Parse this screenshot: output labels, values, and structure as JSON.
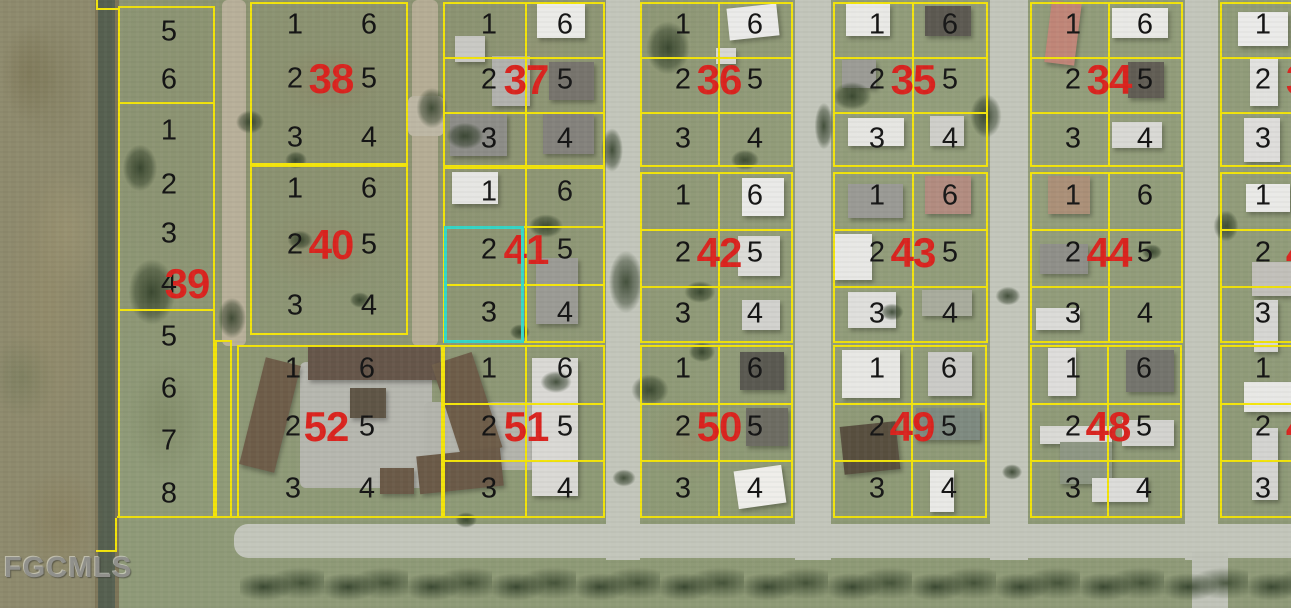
{
  "watermark": "FGCMLS",
  "colors": {
    "parcel_line": "#f3e40b",
    "block_number": "#da241f",
    "lot_number": "#151515",
    "highlight": "#35d8c8",
    "road": "#c3c6bb",
    "grass": "#8f9a78"
  },
  "highlighted_parcel": {
    "block": "41",
    "lots": [
      "2",
      "3"
    ]
  },
  "map": {
    "width": 1291,
    "height": 608,
    "highlight": {
      "x": 444,
      "y": 226,
      "w": 80,
      "h": 117
    },
    "blocks": [
      {
        "number": "38",
        "x": 250,
        "y": 2,
        "w": 158,
        "h": 163,
        "lots_left": [
          "1",
          "2",
          "3"
        ],
        "lots_right": [
          "6",
          "5",
          "4"
        ],
        "internal": false,
        "partial": false
      },
      {
        "number": "37",
        "x": 443,
        "y": 2,
        "w": 162,
        "h": 165,
        "lots_left": [
          "1",
          "2",
          "3"
        ],
        "lots_right": [
          "6",
          "5",
          "4"
        ],
        "internal": true,
        "partial": false
      },
      {
        "number": "36",
        "x": 640,
        "y": 2,
        "w": 153,
        "h": 165,
        "lots_left": [
          "1",
          "2",
          "3"
        ],
        "lots_right": [
          "6",
          "5",
          "4"
        ],
        "internal": true,
        "partial": false
      },
      {
        "number": "35",
        "x": 833,
        "y": 2,
        "w": 155,
        "h": 165,
        "lots_left": [
          "1",
          "2",
          "3"
        ],
        "lots_right": [
          "6",
          "5",
          "4"
        ],
        "internal": true,
        "partial": false
      },
      {
        "number": "34",
        "x": 1030,
        "y": 2,
        "w": 153,
        "h": 165,
        "lots_left": [
          "1",
          "2",
          "3"
        ],
        "lots_right": [
          "6",
          "5",
          "4"
        ],
        "internal": true,
        "partial": false
      },
      {
        "number": "3",
        "x": 1220,
        "y": 2,
        "w": 150,
        "h": 165,
        "lots_left": [
          "1",
          "2",
          "3"
        ],
        "lots_right": [],
        "internal": true,
        "partial": true
      },
      {
        "number": "40",
        "x": 250,
        "y": 165,
        "w": 158,
        "h": 170,
        "lots_left": [
          "1",
          "2",
          "3"
        ],
        "lots_right": [
          "6",
          "5",
          "4"
        ],
        "internal": false,
        "partial": false
      },
      {
        "number": "41",
        "x": 443,
        "y": 167,
        "w": 162,
        "h": 176,
        "lots_left": [
          "1",
          "2",
          "3"
        ],
        "lots_right": [
          "6",
          "5",
          "4"
        ],
        "internal": true,
        "partial": false
      },
      {
        "number": "42",
        "x": 640,
        "y": 172,
        "w": 153,
        "h": 171,
        "lots_left": [
          "1",
          "2",
          "3"
        ],
        "lots_right": [
          "6",
          "5",
          "4"
        ],
        "internal": true,
        "partial": false
      },
      {
        "number": "43",
        "x": 833,
        "y": 172,
        "w": 155,
        "h": 171,
        "lots_left": [
          "1",
          "2",
          "3"
        ],
        "lots_right": [
          "6",
          "5",
          "4"
        ],
        "internal": true,
        "partial": false
      },
      {
        "number": "44",
        "x": 1030,
        "y": 172,
        "w": 153,
        "h": 171,
        "lots_left": [
          "1",
          "2",
          "3"
        ],
        "lots_right": [
          "6",
          "5",
          "4"
        ],
        "internal": true,
        "partial": false
      },
      {
        "number": "4",
        "x": 1220,
        "y": 172,
        "w": 150,
        "h": 171,
        "lots_left": [
          "1",
          "2",
          "3"
        ],
        "lots_right": [],
        "internal": true,
        "partial": true
      },
      {
        "number": "52",
        "x": 237,
        "y": 345,
        "w": 206,
        "h": 173,
        "lots_left": [
          "1",
          "2",
          "3"
        ],
        "lots_right": [
          "6",
          "5",
          "4"
        ],
        "internal": false,
        "partial": false,
        "left_fx": 0.26,
        "right_fx": 0.62,
        "red_fx": 0.42
      },
      {
        "number": "51",
        "x": 443,
        "y": 345,
        "w": 162,
        "h": 173,
        "lots_left": [
          "1",
          "2",
          "3"
        ],
        "lots_right": [
          "6",
          "5",
          "4"
        ],
        "internal": true,
        "partial": false
      },
      {
        "number": "50",
        "x": 640,
        "y": 345,
        "w": 153,
        "h": 173,
        "lots_left": [
          "1",
          "2",
          "3"
        ],
        "lots_right": [
          "6",
          "5",
          "4"
        ],
        "internal": true,
        "partial": false
      },
      {
        "number": "49",
        "x": 833,
        "y": 345,
        "w": 154,
        "h": 173,
        "lots_left": [
          "1",
          "2",
          "3"
        ],
        "lots_right": [
          "6",
          "5",
          "4"
        ],
        "internal": true,
        "partial": false
      },
      {
        "number": "48",
        "x": 1030,
        "y": 345,
        "w": 152,
        "h": 173,
        "lots_left": [
          "1",
          "2",
          "3"
        ],
        "lots_right": [
          "6",
          "5",
          "4"
        ],
        "internal": true,
        "partial": false
      },
      {
        "number": "4",
        "x": 1220,
        "y": 345,
        "w": 150,
        "h": 173,
        "lots_left": [
          "1",
          "2",
          "3"
        ],
        "lots_right": [],
        "internal": true,
        "partial": true
      }
    ],
    "left_strip": {
      "x": 118,
      "y": 6,
      "w": 97,
      "red_number": "39",
      "red_cx": 67,
      "red_cy": 276,
      "lots": [
        {
          "label": "5",
          "h": 48
        },
        {
          "label": "6",
          "h": 48
        },
        {
          "label": "1",
          "h": 54
        },
        {
          "label": "2",
          "h": 53
        },
        {
          "label": "3",
          "h": 46
        },
        {
          "label": "4",
          "h": 54
        },
        {
          "label": "5",
          "h": 52
        },
        {
          "label": "6",
          "h": 52
        },
        {
          "label": "7",
          "h": 52
        },
        {
          "label": "8",
          "h": 53
        }
      ],
      "dividers_after": [
        1,
        5
      ],
      "extension": {
        "x": 215,
        "y": 340,
        "w": 17,
        "h": 178
      }
    },
    "extra_lines": [
      {
        "x": 96,
        "y": 0,
        "w": 2,
        "h": 10
      },
      {
        "x": 96,
        "y": 8,
        "w": 24,
        "h": 2
      },
      {
        "x": 115,
        "y": 518,
        "w": 2,
        "h": 34
      },
      {
        "x": 96,
        "y": 550,
        "w": 21,
        "h": 2
      },
      {
        "x": 117,
        "y": 516,
        "w": 122,
        "h": 2
      }
    ],
    "paved": [
      {
        "x": 222,
        "y": 0,
        "w": 24,
        "h": 346,
        "c": "#b8b09a"
      },
      {
        "x": 412,
        "y": 0,
        "w": 26,
        "h": 346,
        "c": "#b5ad95"
      },
      {
        "x": 408,
        "y": 96,
        "w": 36,
        "h": 40,
        "c": "#bdb7a4"
      },
      {
        "x": 300,
        "y": 362,
        "w": 132,
        "h": 126,
        "c": "#b6b7af"
      },
      {
        "x": 424,
        "y": 402,
        "w": 112,
        "h": 68,
        "c": "#b3b4ac"
      }
    ],
    "buildings": [
      {
        "x": 537,
        "y": 4,
        "w": 48,
        "h": 34,
        "c": "#ebebe8",
        "r": 0
      },
      {
        "x": 492,
        "y": 56,
        "w": 38,
        "h": 50,
        "c": "#b2b2ae",
        "r": 0
      },
      {
        "x": 549,
        "y": 62,
        "w": 45,
        "h": 38,
        "c": "#77746d",
        "r": 0
      },
      {
        "x": 450,
        "y": 114,
        "w": 57,
        "h": 42,
        "c": "#8d8d88",
        "r": 0
      },
      {
        "x": 543,
        "y": 114,
        "w": 51,
        "h": 40,
        "c": "#84827c",
        "r": 0
      },
      {
        "x": 455,
        "y": 36,
        "w": 30,
        "h": 26,
        "c": "#c9c9c4",
        "r": 0
      },
      {
        "x": 728,
        "y": 6,
        "w": 50,
        "h": 32,
        "c": "#ebebe9",
        "r": -6
      },
      {
        "x": 716,
        "y": 48,
        "w": 20,
        "h": 16,
        "c": "#d8d8d4",
        "r": 0
      },
      {
        "x": 846,
        "y": 4,
        "w": 44,
        "h": 32,
        "c": "#e9e9e6",
        "r": 0
      },
      {
        "x": 925,
        "y": 6,
        "w": 46,
        "h": 30,
        "c": "#5c5951",
        "r": 0
      },
      {
        "x": 842,
        "y": 60,
        "w": 34,
        "h": 28,
        "c": "#9c9c96",
        "r": 0
      },
      {
        "x": 848,
        "y": 118,
        "w": 56,
        "h": 28,
        "c": "#e6e6e2",
        "r": 0
      },
      {
        "x": 930,
        "y": 116,
        "w": 34,
        "h": 30,
        "c": "#cfcfca",
        "r": 0
      },
      {
        "x": 1048,
        "y": 2,
        "w": 30,
        "h": 62,
        "c": "#c08678",
        "r": 7
      },
      {
        "x": 1112,
        "y": 8,
        "w": 56,
        "h": 30,
        "c": "#e9e9e6",
        "r": 0
      },
      {
        "x": 1128,
        "y": 62,
        "w": 36,
        "h": 36,
        "c": "#615d54",
        "r": 0
      },
      {
        "x": 1112,
        "y": 122,
        "w": 50,
        "h": 26,
        "c": "#d9d9d5",
        "r": 0
      },
      {
        "x": 1238,
        "y": 12,
        "w": 50,
        "h": 34,
        "c": "#ebebe9",
        "r": 0
      },
      {
        "x": 1250,
        "y": 58,
        "w": 28,
        "h": 48,
        "c": "#e2e2df",
        "r": 0
      },
      {
        "x": 1244,
        "y": 118,
        "w": 36,
        "h": 44,
        "c": "#dedddb",
        "r": 0
      },
      {
        "x": 452,
        "y": 172,
        "w": 46,
        "h": 32,
        "c": "#e6e6e3",
        "r": 0
      },
      {
        "x": 536,
        "y": 258,
        "w": 42,
        "h": 66,
        "c": "#9b9b95",
        "r": 0
      },
      {
        "x": 742,
        "y": 178,
        "w": 42,
        "h": 38,
        "c": "#eaeae8",
        "r": 0
      },
      {
        "x": 738,
        "y": 236,
        "w": 42,
        "h": 40,
        "c": "#dcdcd8",
        "r": 0
      },
      {
        "x": 742,
        "y": 300,
        "w": 38,
        "h": 30,
        "c": "#d2d2ce",
        "r": 0
      },
      {
        "x": 848,
        "y": 184,
        "w": 55,
        "h": 34,
        "c": "#9a9a95",
        "r": 0
      },
      {
        "x": 925,
        "y": 176,
        "w": 46,
        "h": 38,
        "c": "#b28c80",
        "r": 0
      },
      {
        "x": 834,
        "y": 234,
        "w": 38,
        "h": 46,
        "c": "#e8e8e5",
        "r": 0
      },
      {
        "x": 848,
        "y": 292,
        "w": 48,
        "h": 36,
        "c": "#dfdfdc",
        "r": 0
      },
      {
        "x": 922,
        "y": 290,
        "w": 50,
        "h": 26,
        "c": "#a9ac9d",
        "r": 0
      },
      {
        "x": 1048,
        "y": 176,
        "w": 42,
        "h": 38,
        "c": "#ab9078",
        "r": 0
      },
      {
        "x": 1040,
        "y": 244,
        "w": 48,
        "h": 30,
        "c": "#8f8f89",
        "r": 0
      },
      {
        "x": 1036,
        "y": 308,
        "w": 44,
        "h": 22,
        "c": "#dbdbd8",
        "r": 0
      },
      {
        "x": 1246,
        "y": 184,
        "w": 44,
        "h": 28,
        "c": "#eaeae7",
        "r": 0
      },
      {
        "x": 1252,
        "y": 262,
        "w": 40,
        "h": 34,
        "c": "#c2c0ba",
        "r": 0
      },
      {
        "x": 1254,
        "y": 300,
        "w": 24,
        "h": 52,
        "c": "#d6d6d3",
        "r": 0
      },
      {
        "x": 252,
        "y": 360,
        "w": 36,
        "h": 110,
        "c": "#6e5d49",
        "r": 14
      },
      {
        "x": 308,
        "y": 346,
        "w": 132,
        "h": 34,
        "c": "#66564a",
        "r": 0
      },
      {
        "x": 446,
        "y": 356,
        "w": 42,
        "h": 100,
        "c": "#6e5d49",
        "r": -18
      },
      {
        "x": 418,
        "y": 452,
        "w": 84,
        "h": 38,
        "c": "#6b5a48",
        "r": -6
      },
      {
        "x": 350,
        "y": 388,
        "w": 36,
        "h": 30,
        "c": "#5f5546",
        "r": 0
      },
      {
        "x": 380,
        "y": 468,
        "w": 34,
        "h": 26,
        "c": "#6b5a48",
        "r": 0
      },
      {
        "x": 532,
        "y": 358,
        "w": 46,
        "h": 138,
        "c": "#dad9d5",
        "r": 0
      },
      {
        "x": 740,
        "y": 352,
        "w": 44,
        "h": 38,
        "c": "#5a5951",
        "r": 0
      },
      {
        "x": 746,
        "y": 408,
        "w": 42,
        "h": 38,
        "c": "#6d6c62",
        "r": 0
      },
      {
        "x": 736,
        "y": 468,
        "w": 48,
        "h": 38,
        "c": "#efeeea",
        "r": -8
      },
      {
        "x": 842,
        "y": 350,
        "w": 58,
        "h": 48,
        "c": "#e7e7e4",
        "r": 0
      },
      {
        "x": 928,
        "y": 352,
        "w": 44,
        "h": 44,
        "c": "#cbcbc7",
        "r": 0
      },
      {
        "x": 916,
        "y": 408,
        "w": 64,
        "h": 32,
        "c": "#7e8a80",
        "r": 0
      },
      {
        "x": 842,
        "y": 424,
        "w": 56,
        "h": 48,
        "c": "#584f3f",
        "r": -6
      },
      {
        "x": 930,
        "y": 470,
        "w": 24,
        "h": 42,
        "c": "#e9e9e6",
        "r": 0
      },
      {
        "x": 1048,
        "y": 348,
        "w": 28,
        "h": 48,
        "c": "#dedddb",
        "r": 0
      },
      {
        "x": 1126,
        "y": 350,
        "w": 48,
        "h": 42,
        "c": "#74746d",
        "r": 0
      },
      {
        "x": 1040,
        "y": 426,
        "w": 72,
        "h": 18,
        "c": "#dadad6",
        "r": 0
      },
      {
        "x": 1122,
        "y": 420,
        "w": 52,
        "h": 26,
        "c": "#d3d3cf",
        "r": 0
      },
      {
        "x": 1060,
        "y": 442,
        "w": 52,
        "h": 42,
        "c": "#8e9784",
        "r": 0
      },
      {
        "x": 1092,
        "y": 478,
        "w": 56,
        "h": 24,
        "c": "#dcdcd9",
        "r": 0
      },
      {
        "x": 1244,
        "y": 382,
        "w": 48,
        "h": 30,
        "c": "#e8e8e5",
        "r": 0
      },
      {
        "x": 1252,
        "y": 428,
        "w": 26,
        "h": 72,
        "c": "#d4d4d1",
        "r": 0
      }
    ],
    "trees": [
      {
        "x": 140,
        "y": 168,
        "rx": 22,
        "ry": 30
      },
      {
        "x": 152,
        "y": 292,
        "rx": 30,
        "ry": 42
      },
      {
        "x": 232,
        "y": 318,
        "rx": 18,
        "ry": 26
      },
      {
        "x": 250,
        "y": 122,
        "rx": 18,
        "ry": 15
      },
      {
        "x": 432,
        "y": 108,
        "rx": 20,
        "ry": 26
      },
      {
        "x": 465,
        "y": 136,
        "rx": 24,
        "ry": 17
      },
      {
        "x": 546,
        "y": 226,
        "rx": 22,
        "ry": 15
      },
      {
        "x": 520,
        "y": 332,
        "rx": 13,
        "ry": 10
      },
      {
        "x": 626,
        "y": 282,
        "rx": 22,
        "ry": 40
      },
      {
        "x": 612,
        "y": 150,
        "rx": 14,
        "ry": 28
      },
      {
        "x": 668,
        "y": 48,
        "rx": 28,
        "ry": 34
      },
      {
        "x": 700,
        "y": 292,
        "rx": 20,
        "ry": 14
      },
      {
        "x": 745,
        "y": 160,
        "rx": 18,
        "ry": 13
      },
      {
        "x": 852,
        "y": 96,
        "rx": 25,
        "ry": 18
      },
      {
        "x": 824,
        "y": 126,
        "rx": 12,
        "ry": 30
      },
      {
        "x": 986,
        "y": 116,
        "rx": 20,
        "ry": 28
      },
      {
        "x": 1008,
        "y": 296,
        "rx": 16,
        "ry": 12
      },
      {
        "x": 1226,
        "y": 226,
        "rx": 16,
        "ry": 20
      },
      {
        "x": 1152,
        "y": 252,
        "rx": 13,
        "ry": 10
      },
      {
        "x": 650,
        "y": 390,
        "rx": 24,
        "ry": 20
      },
      {
        "x": 702,
        "y": 352,
        "rx": 17,
        "ry": 13
      },
      {
        "x": 624,
        "y": 478,
        "rx": 15,
        "ry": 11
      },
      {
        "x": 892,
        "y": 312,
        "rx": 15,
        "ry": 11
      },
      {
        "x": 1012,
        "y": 472,
        "rx": 13,
        "ry": 10
      },
      {
        "x": 556,
        "y": 382,
        "rx": 20,
        "ry": 14
      },
      {
        "x": 466,
        "y": 520,
        "rx": 14,
        "ry": 10
      },
      {
        "x": 300,
        "y": 240,
        "rx": 16,
        "ry": 12
      },
      {
        "x": 360,
        "y": 300,
        "rx": 13,
        "ry": 10
      },
      {
        "x": 296,
        "y": 160,
        "rx": 14,
        "ry": 11
      }
    ],
    "patches": [
      {
        "x": 330,
        "y": 80,
        "rx": 70,
        "ry": 45,
        "c": "rgba(138,127,95,0.45)"
      },
      {
        "x": 320,
        "y": 250,
        "rx": 80,
        "ry": 55,
        "c": "rgba(142,132,100,0.40)"
      },
      {
        "x": 165,
        "y": 420,
        "rx": 50,
        "ry": 80,
        "c": "rgba(120,130,95,0.50)"
      },
      {
        "x": 690,
        "y": 440,
        "rx": 55,
        "ry": 60,
        "c": "rgba(146,140,105,0.40)"
      },
      {
        "x": 540,
        "y": 60,
        "rx": 50,
        "ry": 40,
        "c": "rgba(155,150,120,0.30)"
      },
      {
        "x": 48,
        "y": 300,
        "rx": 60,
        "ry": 200,
        "c": "rgba(150,140,105,0.50)"
      },
      {
        "x": 48,
        "y": 80,
        "rx": 55,
        "ry": 90,
        "c": "rgba(125,120,88,0.50)"
      },
      {
        "x": 60,
        "y": 520,
        "rx": 60,
        "ry": 70,
        "c": "rgba(130,122,92,0.50)"
      },
      {
        "x": 900,
        "y": 240,
        "rx": 120,
        "ry": 60,
        "c": "rgba(148,158,122,0.35)"
      },
      {
        "x": 1100,
        "y": 100,
        "rx": 100,
        "ry": 70,
        "c": "rgba(150,160,124,0.30)"
      }
    ]
  }
}
